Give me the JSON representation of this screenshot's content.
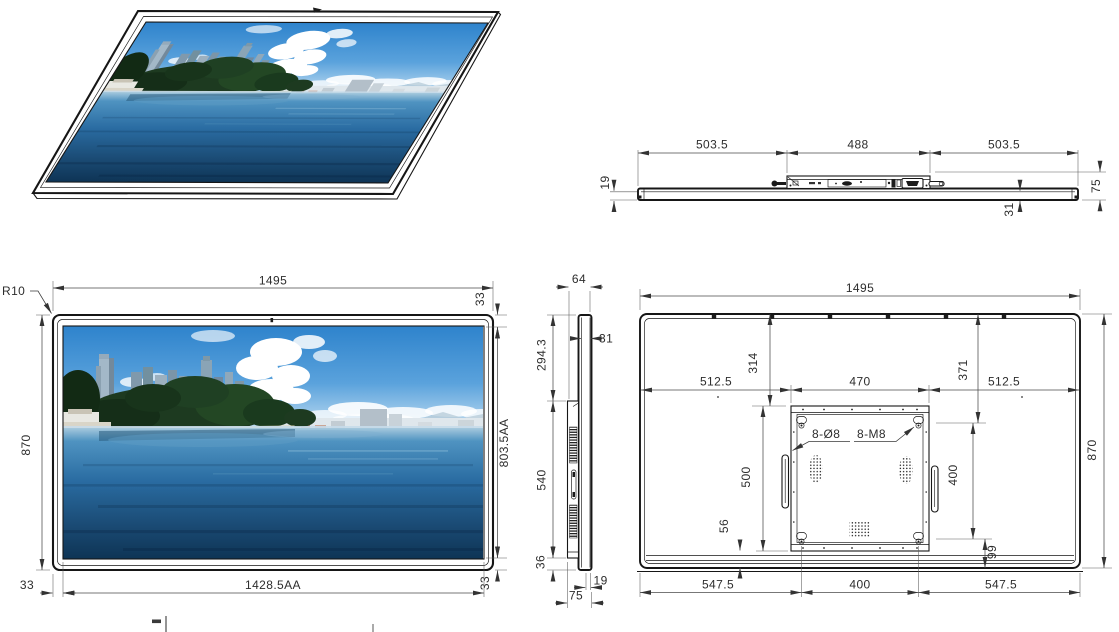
{
  "drawing": {
    "background": "#ffffff",
    "line_color": "#161616",
    "dim_color": "#2d2d2d"
  },
  "photo": {
    "description": "Coastal city skyline with high-rise towers, pine trees, sandy beach and calm blue sea under a partly cloudy sky",
    "palette": {
      "sky_top": "#2e83cc",
      "sky_horizon": "#c2def2",
      "cloud": "#ffffff",
      "trees": "#1d3a20",
      "sand": "#d8cea9",
      "water_main": "#4f93c1",
      "water_deep": "#0e3455"
    }
  },
  "dims": {
    "top_view": {
      "left_span": "503.5",
      "center_span": "488",
      "right_span": "503.5",
      "glass_thickness": "19",
      "panel_thickness": "31",
      "total_depth": "75"
    },
    "front_view": {
      "overall_width": "1495",
      "overall_height": "870",
      "corner_radius": "R10",
      "top_bezel": "33",
      "active_height": "803.5AA",
      "bottom_bezel": "33",
      "left_bezel": "33",
      "active_width": "1428.5AA"
    },
    "side_view": {
      "top_depth": "64",
      "panel_depth": "31",
      "top_to_mount": "294.3",
      "mount_height": "540",
      "mount_to_bottom": "36",
      "glass_thickness": "19",
      "total_depth": "75"
    },
    "rear_view": {
      "overall_width": "1495",
      "overall_height": "870",
      "left_span": "512.5",
      "mount_width": "470",
      "right_span": "512.5",
      "top_to_mount": "314",
      "top_to_hole": "371",
      "hole_callout_dia": "8-Ø8",
      "hole_callout_thread": "8-M8",
      "mount_height_dim": "500",
      "mount_to_bottom": "56",
      "hole_spacing_v": "400",
      "hole_to_bottom": "99",
      "bottom_left_span": "547.5",
      "hole_spacing_h": "400",
      "bottom_right_span": "547.5"
    }
  }
}
